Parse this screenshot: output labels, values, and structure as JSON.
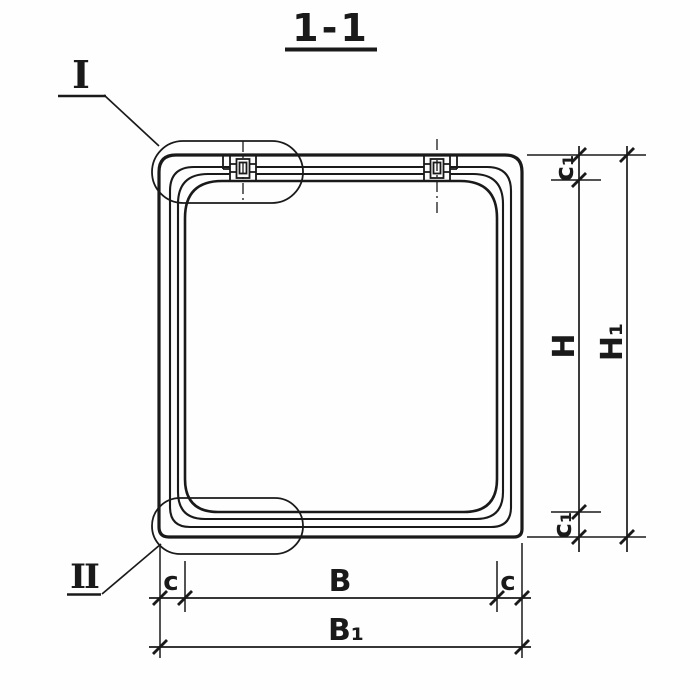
{
  "title": "1-1",
  "details": {
    "one": "I",
    "two": "II"
  },
  "dims": {
    "c_left": "c",
    "b": "B",
    "c_right": "c",
    "b1": "B₁",
    "c1_top": "c₁",
    "h": "H",
    "c1_bottom": "c₁",
    "h1": "H₁"
  },
  "colors": {
    "ink": "#1a1a1a",
    "paper": "#fefefe"
  }
}
